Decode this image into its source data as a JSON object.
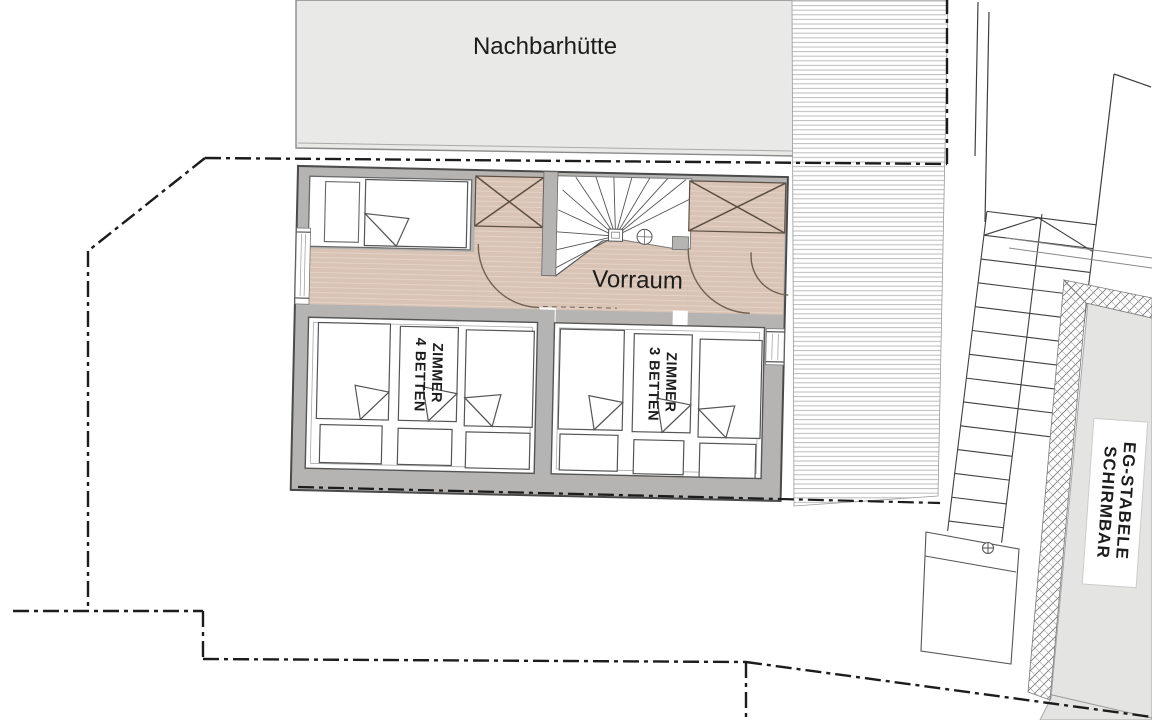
{
  "drawing": {
    "neighbor_hut_label": "Nachbarhütte",
    "vorraum_label": "Vorraum",
    "room_left_label_line1": "ZIMMER",
    "room_left_label_line2": "4 BETTEN",
    "room_right_label_line1": "ZIMMER",
    "room_right_label_line2": "3 BETTEN",
    "eg_label_line1": "EG-STABELE",
    "eg_label_line2": "SCHIRMBAR"
  },
  "colors": {
    "paper": "#ffffff",
    "neighbor_fill": "#e9e9e8",
    "wall_fill": "#b6b4b2",
    "floor_tan": "#d9c3b4",
    "floor_tan_stripe": "#e4d3c7",
    "room_gray": "#e4e4e2",
    "stripe_line": "#bcbcbc",
    "ink": "#1c1c1c",
    "wood_line": "#6f6253"
  }
}
